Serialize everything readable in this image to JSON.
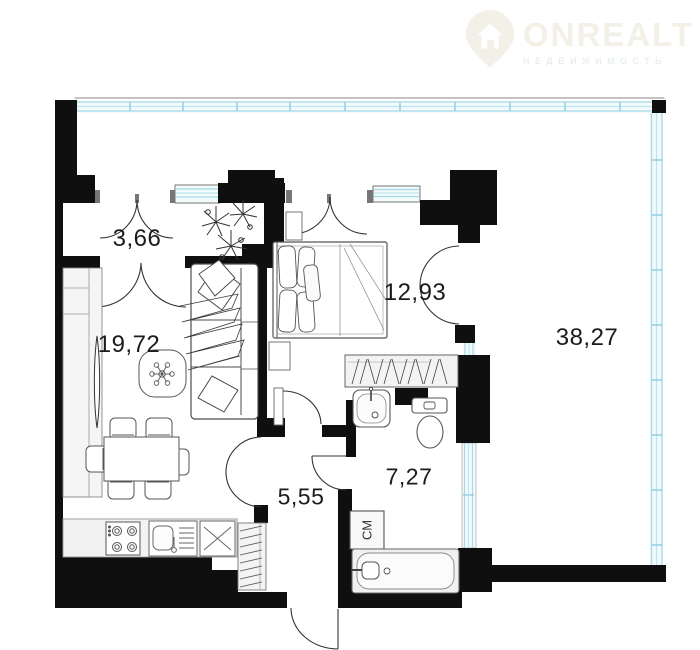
{
  "brand": {
    "name": "ONREALT",
    "tagline": "НЕДВИЖИМОСТЬ",
    "logo_icon": "map-pin-house-icon",
    "text_color": "#f2f0e7",
    "tagline_color": "#e9eff1"
  },
  "floorplan": {
    "type": "apartment-floor-plan",
    "rooms": [
      {
        "name": "hallway",
        "area_label": "3,66"
      },
      {
        "name": "living-room-kitchen",
        "area_label": "19,72"
      },
      {
        "name": "bedroom",
        "area_label": "12,93"
      },
      {
        "name": "terrace",
        "area_label": "38,27"
      },
      {
        "name": "corridor",
        "area_label": "5,55"
      },
      {
        "name": "bathroom",
        "area_label": "7,27"
      }
    ],
    "appliances": {
      "washing_machine_label": "СМ"
    },
    "colors": {
      "wall": "#0f0f0f",
      "glazing_line": "#a6d9e9",
      "glazing_fill": "#f2fafc",
      "furniture_line": "#4d4d4d",
      "label_text": "#1b1b1b"
    }
  }
}
